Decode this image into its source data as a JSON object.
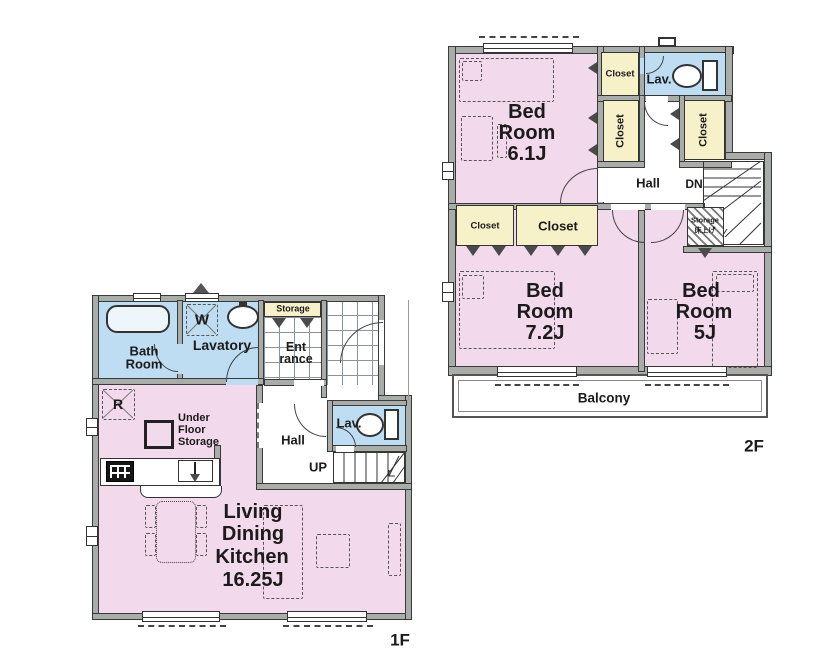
{
  "title": "2-story house floor plan",
  "colors": {
    "room_pink": "#f3d9ec",
    "wet_area_blue": "#bedcf2",
    "closet_cream": "#f6f1c8",
    "wall_gray": "#a9ada9",
    "line": "#333333"
  },
  "floor1": {
    "label": "1F",
    "bath": {
      "line1": "Bath",
      "line2": "Room"
    },
    "lavatory": "Lavatory",
    "washer_mark": "W",
    "fridge_mark": "R",
    "storage": "Storage",
    "entrance": {
      "line1": "Ent",
      "line2": "rance"
    },
    "hall": "Hall",
    "lav": "Lav.",
    "up": "UP",
    "under_floor_storage": {
      "line1": "Under",
      "line2": "Floor",
      "line3": "Storage"
    },
    "ldk": {
      "line1": "Living",
      "line2": "Dining",
      "line3": "Kitchen",
      "area": "16.25J"
    }
  },
  "floor2": {
    "label": "2F",
    "bedroom_61": {
      "line1": "Bed",
      "line2": "Room",
      "area": "6.1J"
    },
    "bedroom_72": {
      "line1": "Bed",
      "line2": "Room",
      "area": "7.2J"
    },
    "bedroom_5": {
      "line1": "Bed",
      "line2": "Room",
      "area": "5J"
    },
    "closet_top": "Closet",
    "closet_left": "Closet",
    "closet_right": "Closet",
    "closet_a": "Closet",
    "closet_b": "Closet",
    "lav": "Lav.",
    "hall": "Hall",
    "dn": "DN",
    "storage": {
      "line1": "Storage",
      "line2": "床上げ"
    },
    "balcony": "Balcony"
  }
}
